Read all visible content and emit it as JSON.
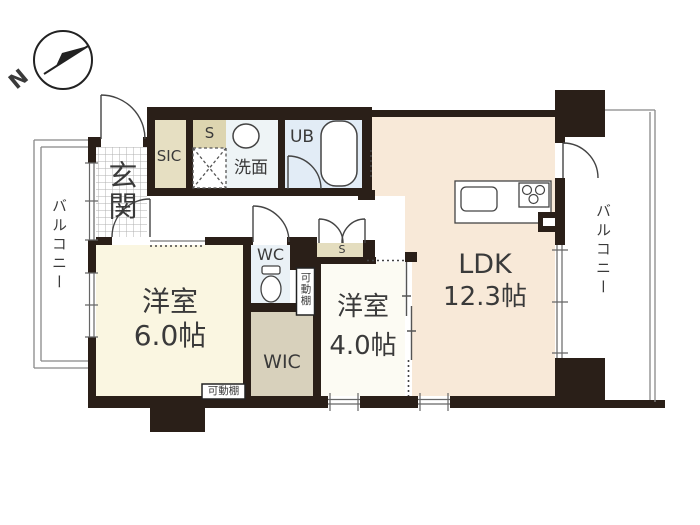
{
  "floorplan": {
    "compass": {
      "label": "N"
    },
    "balcony_left": {
      "label": "バルコニー"
    },
    "balcony_right": {
      "label": "バルコニー"
    },
    "entrance": {
      "label": "玄関"
    },
    "sic": {
      "label": "SIC"
    },
    "storage_top": {
      "label": "S"
    },
    "washroom": {
      "label": "洗面"
    },
    "unit_bath": {
      "label": "UB"
    },
    "wc": {
      "label": "WC"
    },
    "wic": {
      "label": "WIC"
    },
    "storage_closet": {
      "label": "S"
    },
    "shelf_vertical": {
      "label": "可動棚"
    },
    "shelf_bottom": {
      "label": "可動棚"
    },
    "ldk": {
      "label": "LDK",
      "size": "12.3帖"
    },
    "bedroom1": {
      "label": "洋室",
      "size": "6.0帖"
    },
    "bedroom2": {
      "label": "洋室",
      "size": "4.0帖"
    },
    "colors": {
      "wall": "#2a1f18",
      "ldk_floor": "#f8e9d8",
      "bedroom1_floor": "#faf6e1",
      "bedroom2_floor": "#fcfbf3",
      "wic_floor": "#d8d1bc",
      "sic_box": "#e6dfc2",
      "storage_top_box": "#ddd5b0",
      "storage_closet_box": "#e4ddbf",
      "washroom_floor": "#eef4f6",
      "unit_bath_floor": "#e2ecf6",
      "wc_floor": "#eaf1f6"
    }
  }
}
